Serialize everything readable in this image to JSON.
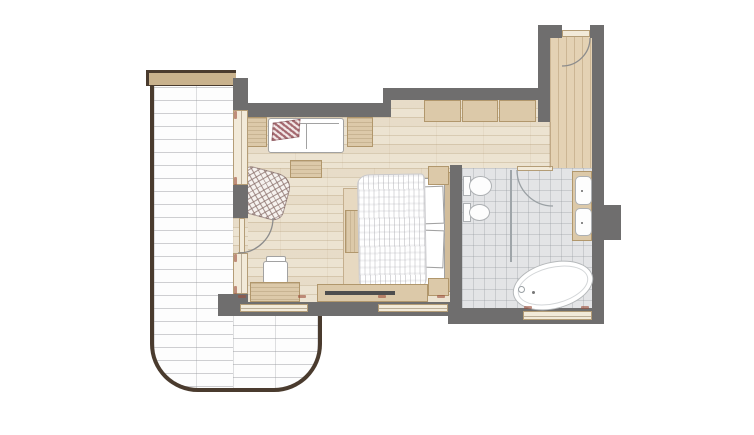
{
  "meta": {
    "kind": "architectural-floor-plan",
    "rendered_text": "none (plan contains only illegible micro dimension ticks)"
  },
  "colors": {
    "wall": "#6f6e6e",
    "terrace_edge": "#4a3b2e",
    "cap": "#c9b28d",
    "floor": "#ece3d1",
    "corridor_floor": "#e4d2b4",
    "tile": "#e3e4e6",
    "furn": "#dcc9a9",
    "furn_edge": "#b1976c",
    "window": "#f2ead9",
    "window_edge": "#b49d77",
    "rug": "#e7d9c1",
    "outline": "#a2a2a2",
    "throw": "#a4686f",
    "tv": "#4e4e4e",
    "mark": "#9c4f3a"
  },
  "rooms": [
    {
      "id": "terrace",
      "floor_finish": "white-brick-paving"
    },
    {
      "id": "bedroom-living",
      "floor_finish": "wood-planks-horizontal"
    },
    {
      "id": "entry-corridor",
      "floor_finish": "wood-planks-vertical"
    },
    {
      "id": "bathroom",
      "floor_finish": "grey-tiles"
    }
  ],
  "furniture": [
    "sofa",
    "sofa-throw",
    "side-table-left",
    "side-table-right",
    "coffee-table",
    "armchair-crosshatch",
    "desk",
    "desk-chair",
    "tv-console",
    "tv",
    "bed",
    "bed-duvet",
    "bed-pillows",
    "headboard",
    "nightstand-top",
    "nightstand-bottom",
    "bed-rug",
    "foot-bench",
    "wardrobe-3-sections"
  ],
  "fixtures": [
    "toilet",
    "bidet",
    "vanity-two-sinks",
    "freestanding-bathtub",
    "shower-partition",
    "entry-door-swing",
    "bathroom-door-swing",
    "balcony-door-swing"
  ],
  "marks": {
    "horizontal": [
      [
        238,
        295
      ],
      [
        298,
        295
      ],
      [
        378,
        295
      ],
      [
        437,
        295
      ],
      [
        524,
        306
      ],
      [
        581,
        306
      ]
    ],
    "vertical": [
      [
        234,
        111
      ],
      [
        234,
        177
      ],
      [
        234,
        254
      ],
      [
        234,
        286
      ]
    ]
  }
}
